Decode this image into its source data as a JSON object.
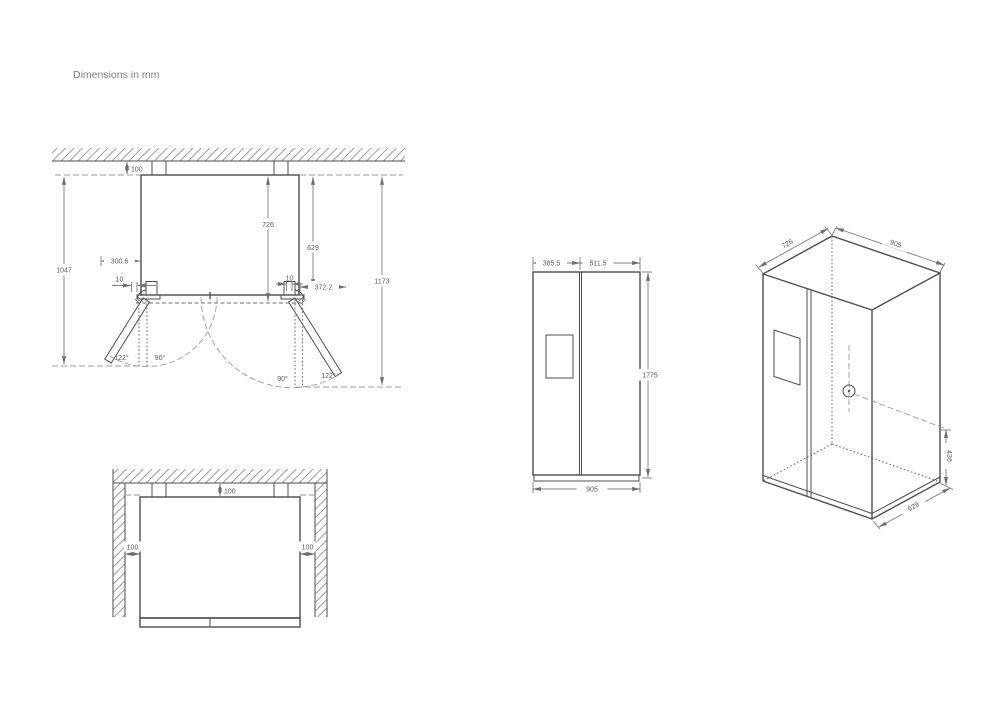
{
  "title": "Dimensions in mm",
  "top_view": {
    "rear_clearance": "100",
    "depth_with_doors": "726",
    "cabinet_depth": "629",
    "left_door_side_clearance": "300.6",
    "overall_depth_left_door_open": "1047",
    "left_hinge_offset": "10",
    "right_hinge_offset": "10",
    "right_door_projection": "372.2",
    "overall_depth_right_door_open": "1173",
    "left_door_open_angle": "122°",
    "left_door_right_angle": "90°",
    "right_door_right_angle": "90°",
    "right_door_open_angle": "122°"
  },
  "front_view": {
    "left_door_width": "385.5",
    "right_door_width": "511.5",
    "overall_height": "1775",
    "overall_width": "905"
  },
  "iso_view": {
    "depth": "726",
    "width": "905",
    "water_inlet_height": "436",
    "base_depth": "629"
  },
  "alcove_view": {
    "rear_clearance": "100",
    "left_clearance": "100",
    "right_clearance": "100"
  }
}
